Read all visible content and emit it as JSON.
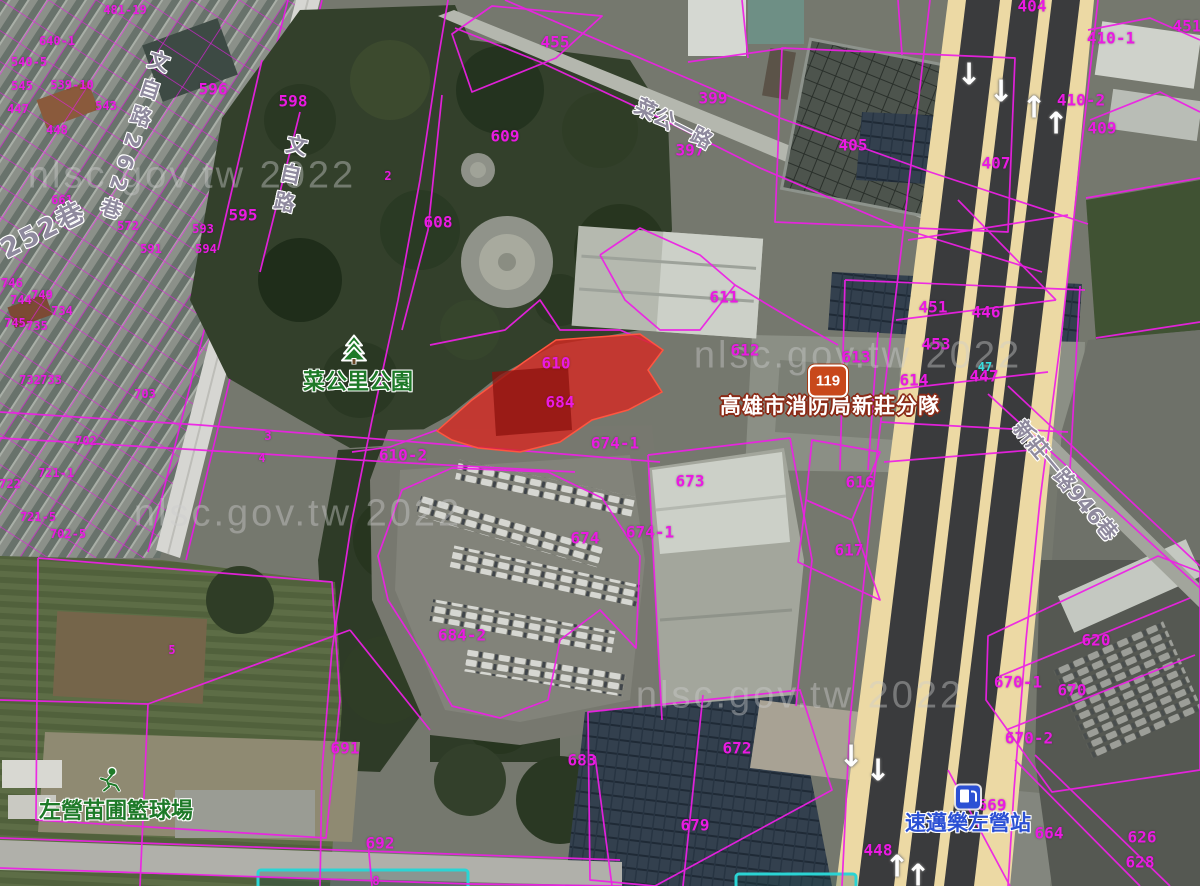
{
  "map": {
    "accent_colors": {
      "cadastral_line": "#ee1fe6",
      "highlight_parcel": "#d62822",
      "road_fill": "#ecd9a4",
      "park_green": "#33402b"
    },
    "watermark": {
      "text": "nlsc.gov.tw 2022",
      "instances": [
        {
          "x": 192,
          "y": 176
        },
        {
          "x": 298,
          "y": 514
        },
        {
          "x": 858,
          "y": 356
        },
        {
          "x": 800,
          "y": 696
        }
      ]
    },
    "route_shield": {
      "number": "119"
    },
    "poi_labels": [
      {
        "t": "菜公里公園",
        "x": 358,
        "y": 380,
        "cls": "green"
      },
      {
        "t": "左營苗圃籃球場",
        "x": 116,
        "y": 809,
        "cls": "green"
      },
      {
        "t": "高雄市消防局新莊分隊",
        "x": 830,
        "y": 405,
        "cls": "fire"
      },
      {
        "t": "速邁樂左營站",
        "x": 968,
        "y": 822,
        "cls": "gas"
      }
    ],
    "road_labels": [
      {
        "t": "文自路",
        "x": 289,
        "y": 177,
        "vertical": true,
        "rotate": 12
      },
      {
        "t": "文自路262巷",
        "x": 133,
        "y": 138,
        "vertical": true,
        "rotate": 18
      },
      {
        "t": "252巷",
        "x": 42,
        "y": 228,
        "rotate": -27,
        "cls": "big"
      },
      {
        "t": "菜公一路",
        "x": 674,
        "y": 123,
        "rotate": 27
      },
      {
        "t": "新莊一路946巷",
        "x": 1066,
        "y": 480,
        "rotate": 50
      }
    ],
    "parcel_labels": [
      {
        "t": "481-19",
        "x": 125,
        "y": 10,
        "cls": "sm"
      },
      {
        "t": "640-1",
        "x": 57,
        "y": 41,
        "cls": "sm"
      },
      {
        "t": "540-5",
        "x": 29,
        "y": 62,
        "cls": "sm"
      },
      {
        "t": "539-10",
        "x": 72,
        "y": 85,
        "cls": "sm"
      },
      {
        "t": "545",
        "x": 22,
        "y": 86,
        "cls": "sm"
      },
      {
        "t": "543",
        "x": 106,
        "y": 106,
        "cls": "sm"
      },
      {
        "t": "447",
        "x": 18,
        "y": 109,
        "cls": "sm"
      },
      {
        "t": "448",
        "x": 57,
        "y": 130,
        "cls": "sm"
      },
      {
        "t": "661",
        "x": 62,
        "y": 200,
        "cls": "sm"
      },
      {
        "t": "572",
        "x": 128,
        "y": 226,
        "cls": "sm"
      },
      {
        "t": "593",
        "x": 203,
        "y": 229,
        "cls": "sm"
      },
      {
        "t": "591",
        "x": 151,
        "y": 249,
        "cls": "sm"
      },
      {
        "t": "594",
        "x": 206,
        "y": 249,
        "cls": "sm"
      },
      {
        "t": "746",
        "x": 12,
        "y": 283,
        "cls": "sm"
      },
      {
        "t": "749",
        "x": 42,
        "y": 295,
        "cls": "sm"
      },
      {
        "t": "744",
        "x": 21,
        "y": 300,
        "cls": "sm"
      },
      {
        "t": "734",
        "x": 62,
        "y": 311,
        "cls": "sm"
      },
      {
        "t": "745",
        "x": 15,
        "y": 323,
        "cls": "sm"
      },
      {
        "t": "735",
        "x": 37,
        "y": 326,
        "cls": "sm"
      },
      {
        "t": "732",
        "x": 30,
        "y": 380,
        "cls": "sm"
      },
      {
        "t": "733",
        "x": 51,
        "y": 380,
        "cls": "sm"
      },
      {
        "t": "703",
        "x": 145,
        "y": 394,
        "cls": "sm"
      },
      {
        "t": "702",
        "x": 86,
        "y": 441,
        "cls": "sm"
      },
      {
        "t": "721-1",
        "x": 56,
        "y": 473,
        "cls": "sm"
      },
      {
        "t": "722",
        "x": 10,
        "y": 484,
        "cls": "sm"
      },
      {
        "t": "721-5",
        "x": 38,
        "y": 517,
        "cls": "sm"
      },
      {
        "t": "702-5",
        "x": 68,
        "y": 534,
        "cls": "sm"
      },
      {
        "t": "596",
        "x": 213,
        "y": 89
      },
      {
        "t": "598",
        "x": 293,
        "y": 101
      },
      {
        "t": "595",
        "x": 243,
        "y": 215
      },
      {
        "t": "455",
        "x": 555,
        "y": 42
      },
      {
        "t": "399",
        "x": 713,
        "y": 98
      },
      {
        "t": "397",
        "x": 690,
        "y": 150
      },
      {
        "t": "404",
        "x": 1032,
        "y": 6
      },
      {
        "t": "405",
        "x": 853,
        "y": 145
      },
      {
        "t": "410-1",
        "x": 1111,
        "y": 38
      },
      {
        "t": "410-2",
        "x": 1081,
        "y": 100
      },
      {
        "t": "409",
        "x": 1102,
        "y": 128
      },
      {
        "t": "407",
        "x": 996,
        "y": 163
      },
      {
        "t": "451",
        "x": 1187,
        "y": 26
      },
      {
        "t": "609",
        "x": 505,
        "y": 136
      },
      {
        "t": "608",
        "x": 438,
        "y": 222
      },
      {
        "t": "611",
        "x": 724,
        "y": 297
      },
      {
        "t": "612",
        "x": 745,
        "y": 350
      },
      {
        "t": "613",
        "x": 856,
        "y": 357
      },
      {
        "t": "614",
        "x": 914,
        "y": 380
      },
      {
        "t": "451",
        "x": 933,
        "y": 307
      },
      {
        "t": "446",
        "x": 986,
        "y": 312
      },
      {
        "t": "453",
        "x": 936,
        "y": 344
      },
      {
        "t": "447",
        "x": 984,
        "y": 376
      },
      {
        "t": "610",
        "x": 556,
        "y": 363
      },
      {
        "t": "684",
        "x": 560,
        "y": 402
      },
      {
        "t": "610-2",
        "x": 403,
        "y": 455
      },
      {
        "t": "674-1",
        "x": 615,
        "y": 443
      },
      {
        "t": "673",
        "x": 690,
        "y": 481
      },
      {
        "t": "674-1",
        "x": 650,
        "y": 532
      },
      {
        "t": "674",
        "x": 585,
        "y": 538
      },
      {
        "t": "684-2",
        "x": 462,
        "y": 635
      },
      {
        "t": "616",
        "x": 860,
        "y": 482
      },
      {
        "t": "617",
        "x": 849,
        "y": 550
      },
      {
        "t": "620",
        "x": 1096,
        "y": 640
      },
      {
        "t": "670-1",
        "x": 1018,
        "y": 682
      },
      {
        "t": "670",
        "x": 1072,
        "y": 690
      },
      {
        "t": "670-2",
        "x": 1029,
        "y": 738
      },
      {
        "t": "691",
        "x": 345,
        "y": 748
      },
      {
        "t": "692",
        "x": 380,
        "y": 843
      },
      {
        "t": "683",
        "x": 582,
        "y": 760
      },
      {
        "t": "672",
        "x": 737,
        "y": 748
      },
      {
        "t": "679",
        "x": 695,
        "y": 825
      },
      {
        "t": "448",
        "x": 878,
        "y": 850
      },
      {
        "t": "669",
        "x": 992,
        "y": 805
      },
      {
        "t": "664",
        "x": 1049,
        "y": 833
      },
      {
        "t": "626",
        "x": 1142,
        "y": 837
      },
      {
        "t": "628",
        "x": 1140,
        "y": 862
      },
      {
        "t": "2",
        "x": 388,
        "y": 176,
        "cls": "sm"
      },
      {
        "t": "3",
        "x": 268,
        "y": 436,
        "cls": "sm"
      },
      {
        "t": "4",
        "x": 262,
        "y": 458,
        "cls": "sm"
      },
      {
        "t": "5",
        "x": 172,
        "y": 650,
        "cls": "sm"
      },
      {
        "t": "8",
        "x": 376,
        "y": 881,
        "cls": "sm"
      },
      {
        "t": "47",
        "x": 985,
        "y": 367,
        "cls": "sm cyan"
      }
    ],
    "arrows": [
      {
        "g": "↓",
        "x": 969,
        "y": 75
      },
      {
        "g": "↓",
        "x": 1001,
        "y": 92
      },
      {
        "g": "↑",
        "x": 1034,
        "y": 108
      },
      {
        "g": "↑",
        "x": 1056,
        "y": 124
      },
      {
        "g": "↓",
        "x": 851,
        "y": 757
      },
      {
        "g": "↓",
        "x": 878,
        "y": 771
      },
      {
        "g": "↑",
        "x": 897,
        "y": 867
      },
      {
        "g": "↑",
        "x": 918,
        "y": 876
      }
    ]
  }
}
